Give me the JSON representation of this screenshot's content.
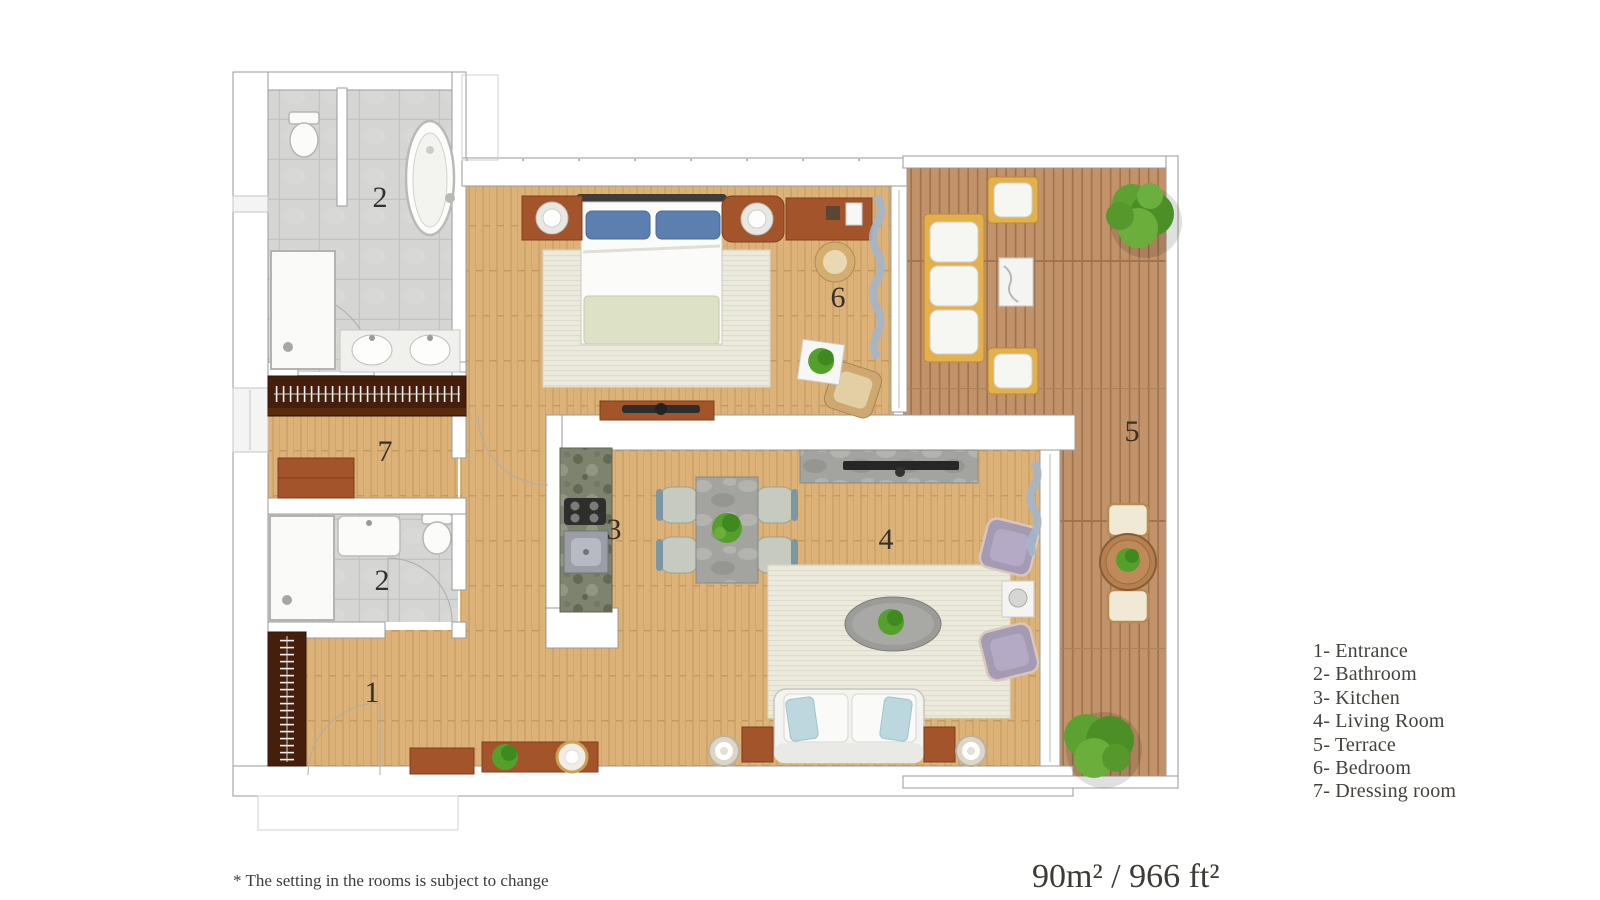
{
  "floor_plan": {
    "area_label": "90m² / 966 ft²",
    "footnote": "* The setting in the rooms is subject to change",
    "room_numbers": {
      "entrance": "1",
      "bathroom_upper": "2",
      "bathroom_lower": "2",
      "kitchen": "3",
      "living_room": "4",
      "terrace": "5",
      "bedroom": "6",
      "dressing_room": "7"
    },
    "legend": {
      "items": [
        "1- Entrance",
        "2- Bathroom",
        "3- Kitchen",
        "4- Living Room",
        "5- Terrace",
        "6- Bedroom",
        "7- Dressing room"
      ]
    },
    "colors": {
      "wood_floor": "#dcb278",
      "terrace_deck": "#c2936a",
      "bathroom_tile": "#d5d5d3",
      "wall": "#ffffff",
      "furniture_wood": "#a4542a",
      "wardrobe_dark": "#451f0c",
      "pillow_blue": "#5b7fae",
      "curtain_blue": "#a3b6ca",
      "plant_green": "#55a02c",
      "text": "#44403a"
    }
  }
}
